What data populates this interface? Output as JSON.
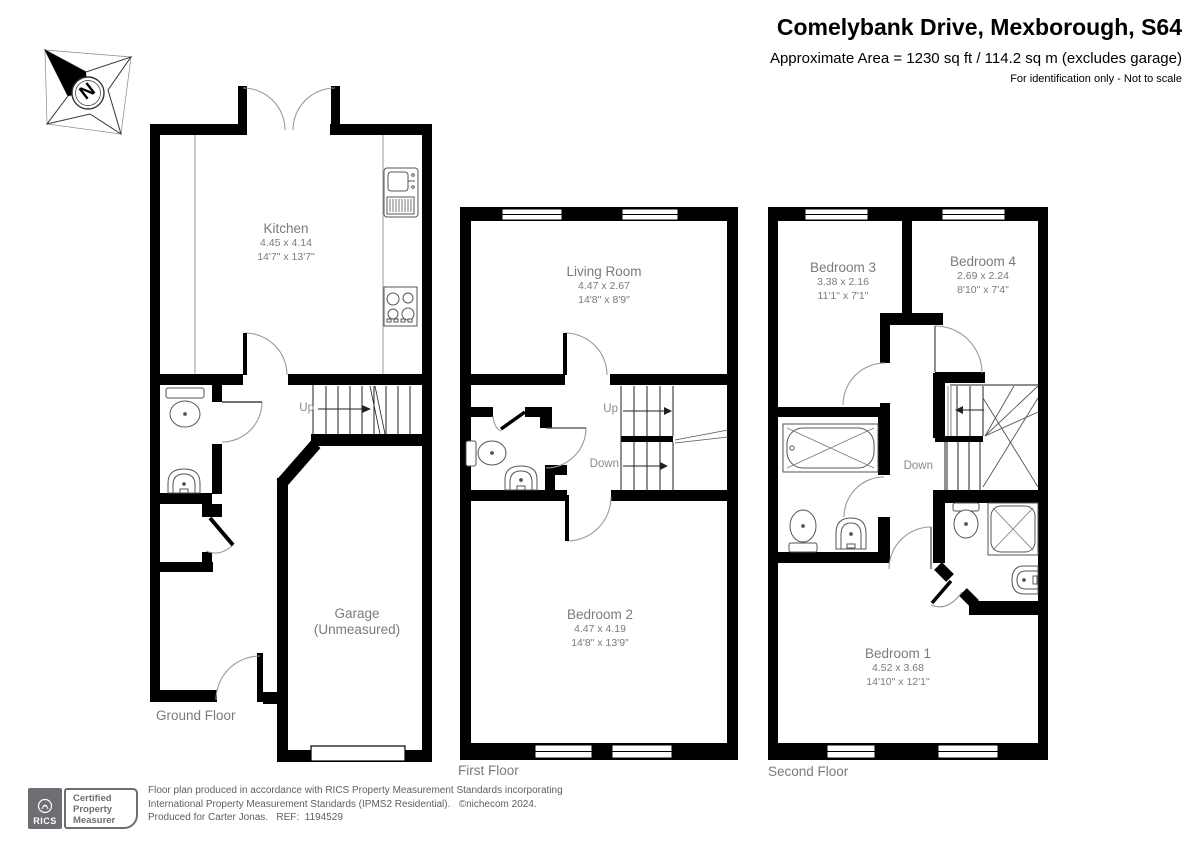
{
  "header": {
    "title": "Comelybank Drive, Mexborough, S64",
    "subtitle": "Approximate Area = 1230 sq ft / 114.2 sq m (excludes garage)",
    "note": "For identification only - Not to scale"
  },
  "compass": {
    "label": "N"
  },
  "floors": [
    {
      "name": "Ground Floor",
      "rooms": [
        {
          "name": "Kitchen",
          "metric": "4.45 x 4.14",
          "imperial": "14'7\" x 13'7\""
        },
        {
          "name": "Garage",
          "metric": "(Unmeasured)",
          "imperial": ""
        }
      ],
      "stairs": {
        "up": "Up"
      }
    },
    {
      "name": "First Floor",
      "rooms": [
        {
          "name": "Living Room",
          "metric": "4.47 x 2.67",
          "imperial": "14'8\" x 8'9\""
        },
        {
          "name": "Bedroom 2",
          "metric": "4.47 x 4.19",
          "imperial": "14'8\" x 13'9\""
        }
      ],
      "stairs": {
        "up": "Up",
        "down": "Down"
      }
    },
    {
      "name": "Second Floor",
      "rooms": [
        {
          "name": "Bedroom 3",
          "metric": "3.38 x 2.16",
          "imperial": "11'1\" x 7'1\""
        },
        {
          "name": "Bedroom 4",
          "metric": "2.69 x 2.24",
          "imperial": "8'10\" x 7'4\""
        },
        {
          "name": "Bedroom 1",
          "metric": "4.52 x 3.68",
          "imperial": "14'10\" x 12'1\""
        }
      ],
      "stairs": {
        "down": "Down"
      }
    }
  ],
  "footer": {
    "badge": {
      "org": "RICS",
      "lines": [
        "Certified",
        "Property",
        "Measurer"
      ]
    },
    "disclaimer": [
      "Floor plan produced in accordance with RICS Property Measurement Standards incorporating",
      "International Property Measurement Standards (IPMS2 Residential).   ©nichecom 2024.",
      "Produced for Carter Jonas.   REF:  1194529"
    ]
  }
}
